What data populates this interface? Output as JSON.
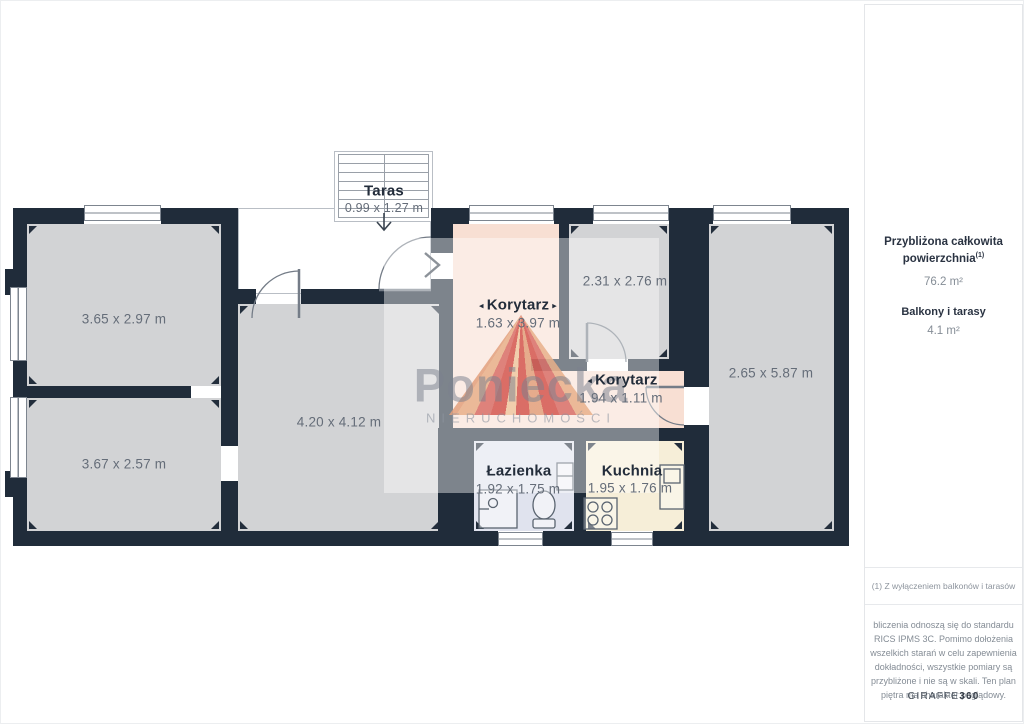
{
  "plan": {
    "taras": {
      "name": "Taras",
      "dims": "0.99 x 1.27 m"
    },
    "room_a": {
      "dims": "3.65 x 2.97 m"
    },
    "room_b": {
      "dims": "3.67 x 2.57 m"
    },
    "central": {
      "dims": "4.20 x 4.12 m"
    },
    "korytarz1": {
      "name": "Korytarz",
      "dims": "1.63 x 3.97 m"
    },
    "room_c": {
      "dims": "2.31 x 2.76 m"
    },
    "korytarz2": {
      "name": "Korytarz",
      "dims": "1.94 x 1.11 m"
    },
    "room_d": {
      "dims": "2.65 x 5.87 m"
    },
    "bathroom": {
      "name": "Łazienka",
      "dims": "1.92 x 1.75 m"
    },
    "kitchen": {
      "name": "Kuchnia",
      "dims": "1.95 x 1.76 m"
    }
  },
  "watermark": {
    "brand": "Poniecka",
    "subtitle": "NIERUCHOMOŚCI"
  },
  "sidebar": {
    "total_label": "Przybliżona całkowita powierzchnia",
    "total_sup": "(1)",
    "total_value": "76.2 m²",
    "balcony_label": "Balkony i tarasy",
    "balcony_value": "4.1 m²",
    "footnote": "(1) Z wyłączeniem balkonów i tarasów",
    "disclaimer": "bliczenia odnoszą się do standardu RICS IPMS 3C. Pomimo dołożenia wszelkich starań w celu zapewnienia dokładności, wszystkie pomiary są przybliżone i nie są w skali. Ten plan piętra ma charakter poglądowy.",
    "brand": "GIRAFFE",
    "brand_bold": "360"
  },
  "colors": {
    "wall": "#202c3a",
    "floor": "#d2d3d5",
    "corridor": "#f8dfd3",
    "bathroom": "#e0e3ee",
    "kitchen": "#f6eed8",
    "logo_red": "#d4574f"
  }
}
